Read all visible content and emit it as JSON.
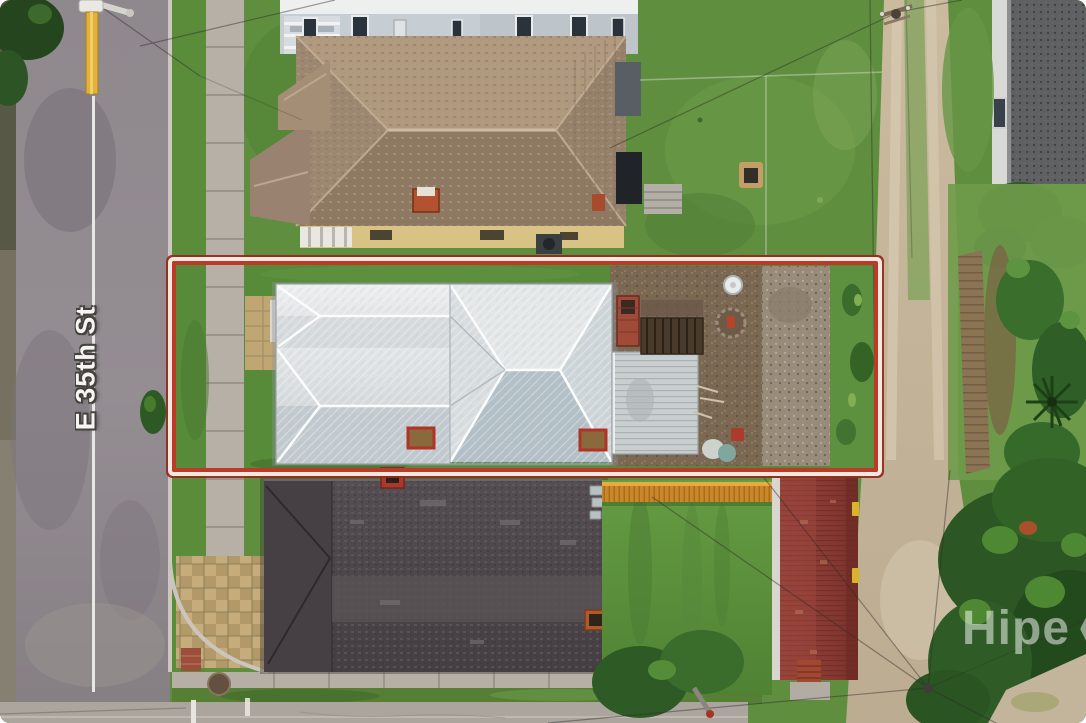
{
  "page": {
    "title": "Aerial property photo"
  },
  "street": {
    "label": "E 35th St"
  },
  "watermark": {
    "text": "Hipe",
    "icon": "hexagon-chevron-icon",
    "color": "#ffffff"
  },
  "property_outline": {
    "shape": "rectangle",
    "outer_line_color": "#96281e",
    "mid_line_color": "#f7f2e9",
    "inner_line_color": "#bd3a2a"
  },
  "scene": {
    "description": "Overhead drone view of a narrow residential lot outlined in red, between two neighboring houses, street at left, sandy alley and trees at right",
    "road": {
      "name": "E 35th St",
      "surface": "asphalt",
      "centerline_color": "#e9e7e3"
    },
    "subject_property": {
      "roof": "white standing-seam metal hip roof",
      "features": [
        "rear garage with corrugated metal roof",
        "brick chimney",
        "rear wooden stairs",
        "satellite dish",
        "dirt and gravel backyard",
        "two red-framed roof vents"
      ]
    },
    "north_neighbor": {
      "roof": "tan asphalt-shingle hip roof",
      "extras": [
        "red chimneys",
        "cream walls",
        "apartment building with balconies beyond"
      ]
    },
    "south_neighbor": {
      "roof": "dark charcoal shingle roof",
      "extras": [
        "orange picket fence",
        "maroon-roof outbuilding",
        "brick chimneys"
      ]
    },
    "right_side": [
      "sandy two-track alley",
      "wooden privacy fence",
      "palm plant",
      "dense trees"
    ],
    "street_furniture": [
      "utility pole with yellow guard",
      "manhole cover",
      "white curb markings",
      "power lines",
      "paver corner walkway"
    ]
  },
  "palette": {
    "grass": "#5f8f3e",
    "asphalt": "#8d868b",
    "concrete": "#b6b0a6",
    "metal_roof": "#e3e6e7",
    "metal_roof_shade": "#b4c0c7",
    "brown_roof": "#a08a72",
    "dark_roof": "#4d464a",
    "maroon_roof": "#8c3a34",
    "outline_red": "#bd3a2a",
    "alley_sand": "#c6b8a1",
    "orange_fence": "#c9862b"
  }
}
